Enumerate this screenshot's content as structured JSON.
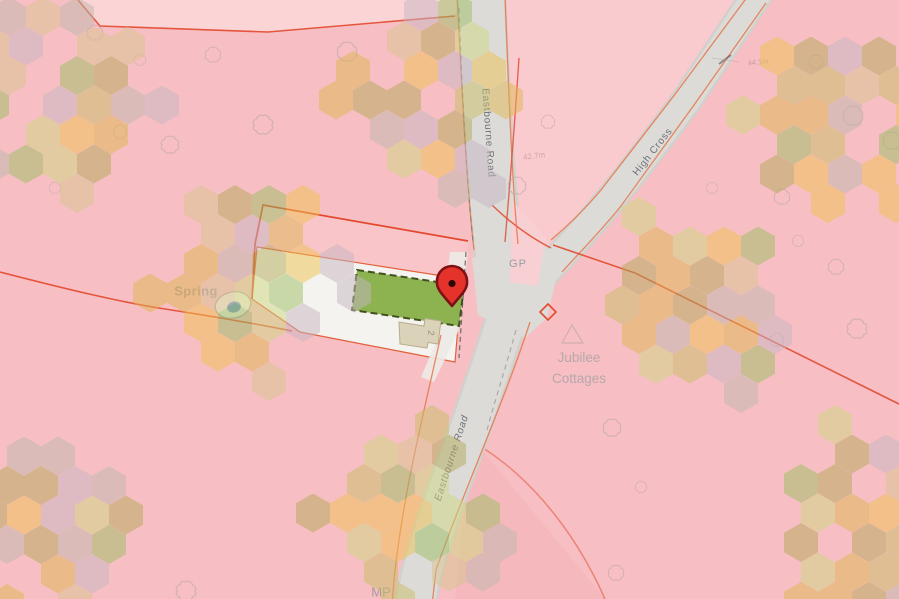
{
  "map": {
    "place_labels": {
      "spring": "Spring",
      "guide_post": "GP",
      "jubilee_line1": "Jubilee",
      "jubilee_line2": "Cottages",
      "milepost": "MP",
      "plot_number": "2"
    },
    "road_labels": {
      "eastbourne_road_upper": "Eastbourne Road",
      "eastbourne_road_lower": "Eastbourne Road",
      "high_cross": "High Cross"
    },
    "annotations": {
      "spot_height_eastbourne": "42.7m",
      "spot_height_high_cross": "44.1m"
    },
    "colors": {
      "base_pink": "#f7bfc3",
      "light_pink": "#fbd4d6",
      "parcel_white": "#f4f3ef",
      "road_gray": "#dcdbd8",
      "plot_green": "#8db350",
      "boundary_red": "#e2492e",
      "road_edge_orange": "#e5754a",
      "pin_red": "#e5322b",
      "pin_outline": "#7c1215",
      "spring_blue": "#7b97cb",
      "building_beige": "#dbd2ba"
    },
    "watermark": {
      "opacity": 0.5,
      "palette": [
        "#eec24d",
        "#e0b64f",
        "#b3a958",
        "#c9bd66",
        "#c6b6c1",
        "#bfb7ad",
        "#9cbd62",
        "#ced87d",
        "#d8c48e"
      ],
      "cluster_centers": [
        [
          60,
          105
        ],
        [
          438,
          100
        ],
        [
          845,
          115
        ],
        [
          252,
          293
        ],
        [
          690,
          305
        ],
        [
          58,
          515
        ],
        [
          415,
          513
        ],
        [
          852,
          513
        ]
      ]
    },
    "trees": [
      [
        140,
        60
      ],
      [
        213,
        55
      ],
      [
        263,
        125
      ],
      [
        120,
        132
      ],
      [
        170,
        145
      ],
      [
        55,
        188
      ],
      [
        95,
        33
      ],
      [
        347,
        52
      ],
      [
        548,
        122
      ],
      [
        517,
        186
      ],
      [
        712,
        188
      ],
      [
        782,
        197
      ],
      [
        853,
        116
      ],
      [
        816,
        62
      ],
      [
        892,
        141
      ],
      [
        798,
        241
      ],
      [
        836,
        267
      ],
      [
        857,
        329
      ],
      [
        777,
        340
      ],
      [
        612,
        428
      ],
      [
        641,
        487
      ],
      [
        616,
        573
      ],
      [
        186,
        591
      ]
    ]
  }
}
